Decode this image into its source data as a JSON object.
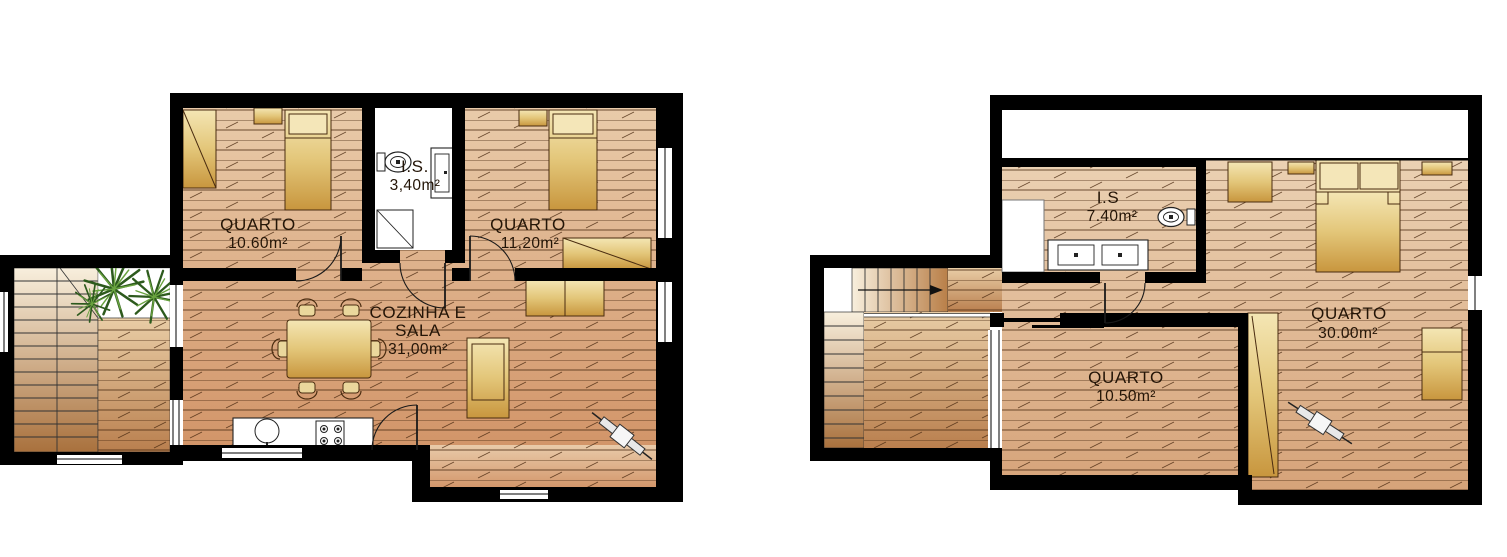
{
  "colors": {
    "wall": "#000000",
    "background": "#ffffff",
    "wood_light": "#ecd2b2",
    "wood_dark": "#d0956a",
    "plank_line": "#4b2a12",
    "furniture_light": "#f4e6b4",
    "furniture_dark": "#c8963e",
    "stair_light": "#f8efdd",
    "stair_dark": "#a9713d",
    "plant_green": "#2d5a1d"
  },
  "plans": [
    {
      "rooms": [
        {
          "label": "QUARTO",
          "area": "10.60m²"
        },
        {
          "label": "I.S.",
          "area": "3,40m²"
        },
        {
          "label": "QUARTO",
          "area": "11,20m²"
        },
        {
          "label": "COZINHA E",
          "label2": "SALA",
          "area": "31,00m²"
        }
      ]
    },
    {
      "rooms": [
        {
          "label": "I.S",
          "area": "7.40m²"
        },
        {
          "label": "QUARTO",
          "area": "30.00m²"
        },
        {
          "label": "QUARTO",
          "area": "10.50m²"
        }
      ]
    }
  ]
}
